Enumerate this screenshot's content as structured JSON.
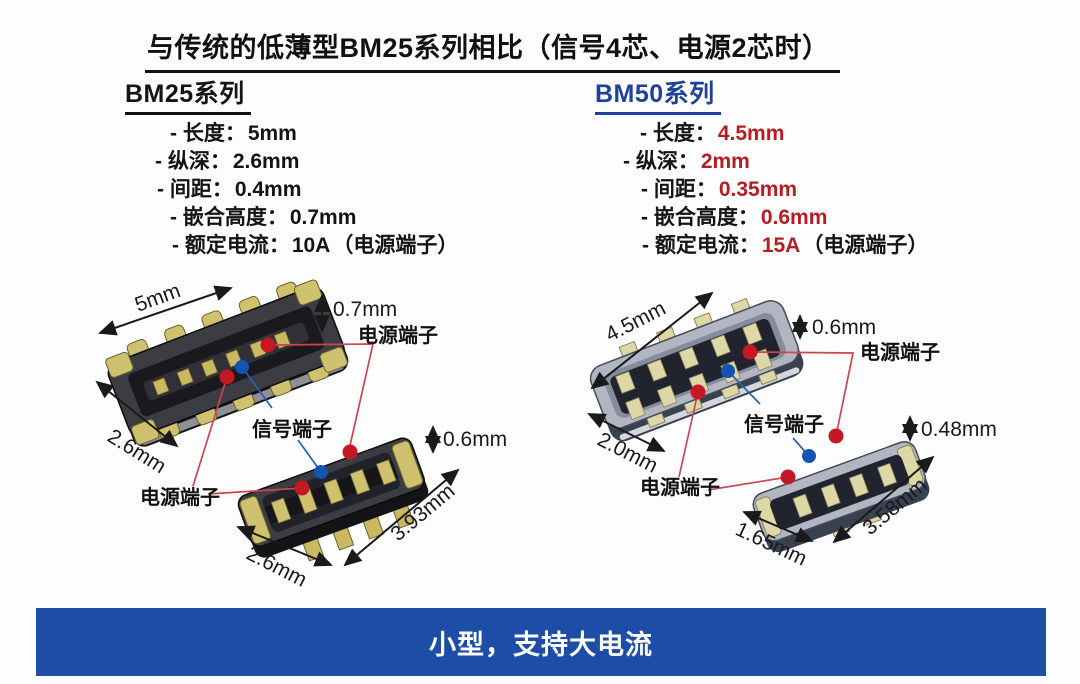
{
  "title": {
    "text": "与传统的低薄型BM25系列相比（信号4芯、电源2芯时）"
  },
  "bm25": {
    "heading": "BM25系列",
    "specs": [
      {
        "label": "- 长度：",
        "value": "5mm",
        "suffix": ""
      },
      {
        "label": "- 纵深：",
        "value": "2.6mm",
        "suffix": ""
      },
      {
        "label": "- 间距：",
        "value": "0.4mm",
        "suffix": ""
      },
      {
        "label": "- 嵌合高度：",
        "value": "0.7mm",
        "suffix": ""
      },
      {
        "label": "- 额定电流：",
        "value": "10A",
        "suffix": "（电源端子）"
      }
    ]
  },
  "bm50": {
    "heading": "BM50系列",
    "specs": [
      {
        "label": "- 长度：",
        "value": "4.5mm",
        "suffix": ""
      },
      {
        "label": "- 纵深：",
        "value": "2mm",
        "suffix": ""
      },
      {
        "label": "- 间距：",
        "value": "0.35mm",
        "suffix": ""
      },
      {
        "label": "- 嵌合高度：",
        "value": "0.6mm",
        "suffix": ""
      },
      {
        "label": "- 额定电流：",
        "value": "15A",
        "suffix": "（电源端子）"
      }
    ]
  },
  "diagram": {
    "bm25": {
      "length": "5mm",
      "mating_height": "0.7mm",
      "depth": "2.6mm",
      "plug_height": "0.6mm",
      "plug_length": "3.93mm",
      "plug_depth": "2.6mm",
      "power_label_top": "电源端子",
      "power_label_bottom": "电源端子",
      "signal_label": "信号端子"
    },
    "bm50": {
      "length": "4.5mm",
      "mating_height": "0.6mm",
      "depth": "2.0mm",
      "plug_height": "0.48mm",
      "plug_length": "3.58mm",
      "plug_depth": "1.65mm",
      "power_label_top": "电源端子",
      "power_label_bottom": "电源端子",
      "signal_label": "信号端子"
    }
  },
  "banner": {
    "text": "小型，支持大电流"
  },
  "colors": {
    "accent_blue": "#1e4199",
    "value_red": "#b61c21",
    "banner_blue": "#1d4da6",
    "terminal_red": "#c41824",
    "terminal_blue": "#1353b4"
  }
}
